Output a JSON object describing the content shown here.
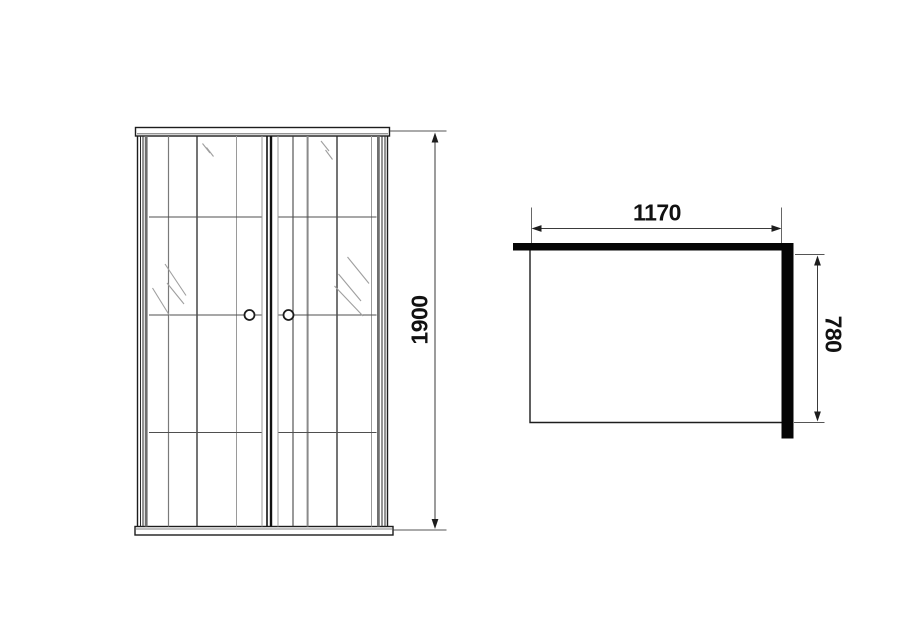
{
  "drawing": {
    "kind": "shower-enclosure-technical-drawing",
    "front_view": {
      "height_dimension": "1900"
    },
    "plan_view": {
      "width_dimension": "1170",
      "depth_dimension": "780"
    },
    "colors": {
      "frame_line": "#1d1d1d",
      "glass_line": "#8c8c8c",
      "solid_wall_fill": "#050505",
      "background": "#ffffff"
    }
  }
}
